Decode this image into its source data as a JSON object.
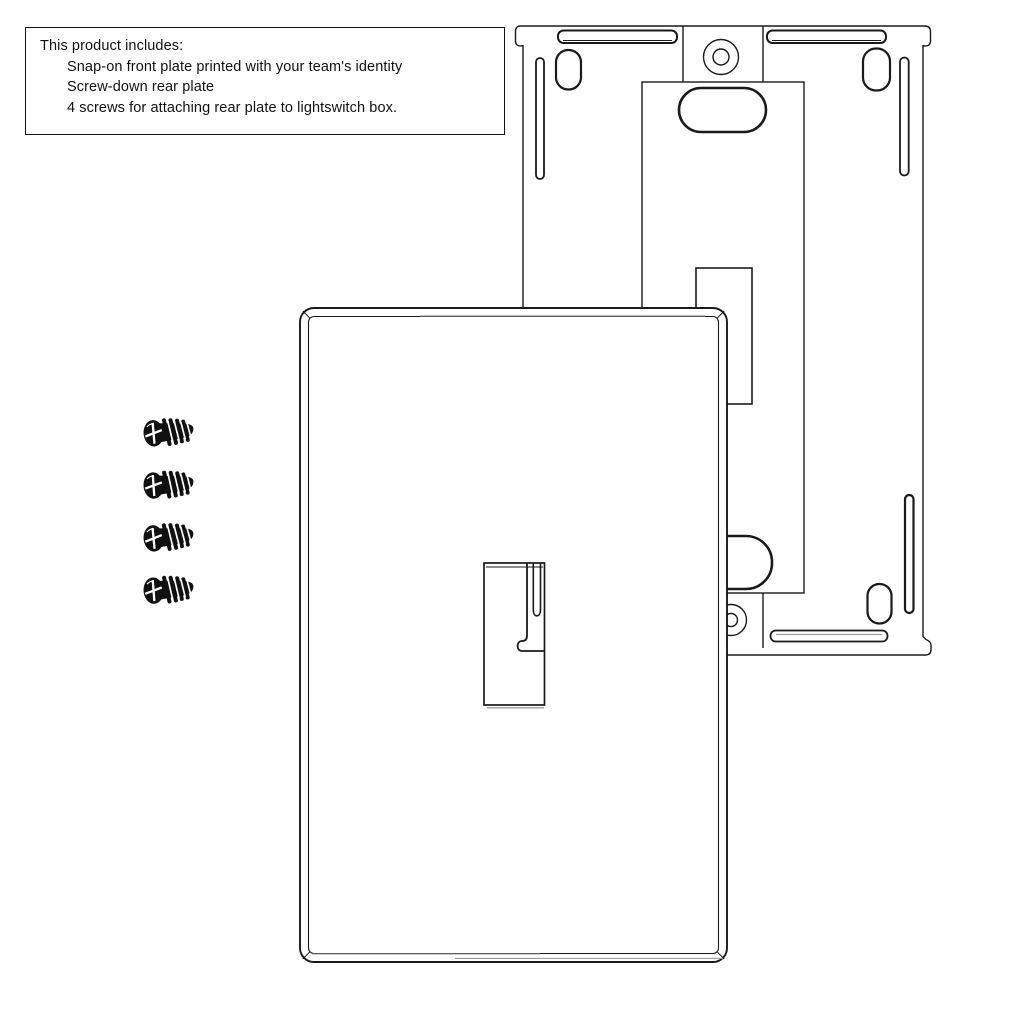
{
  "info_box": {
    "title": "This product includes:",
    "items": [
      "Snap-on front plate printed with your team's identity",
      "Screw-down rear plate",
      "4 screws for attaching rear plate to lightswitch box."
    ]
  },
  "diagram": {
    "screw_count": 4,
    "colors": {
      "line": "#1a1a1a",
      "shadow": "#9e9e9e",
      "screw_fill": "#111111",
      "background": "#ffffff"
    }
  }
}
